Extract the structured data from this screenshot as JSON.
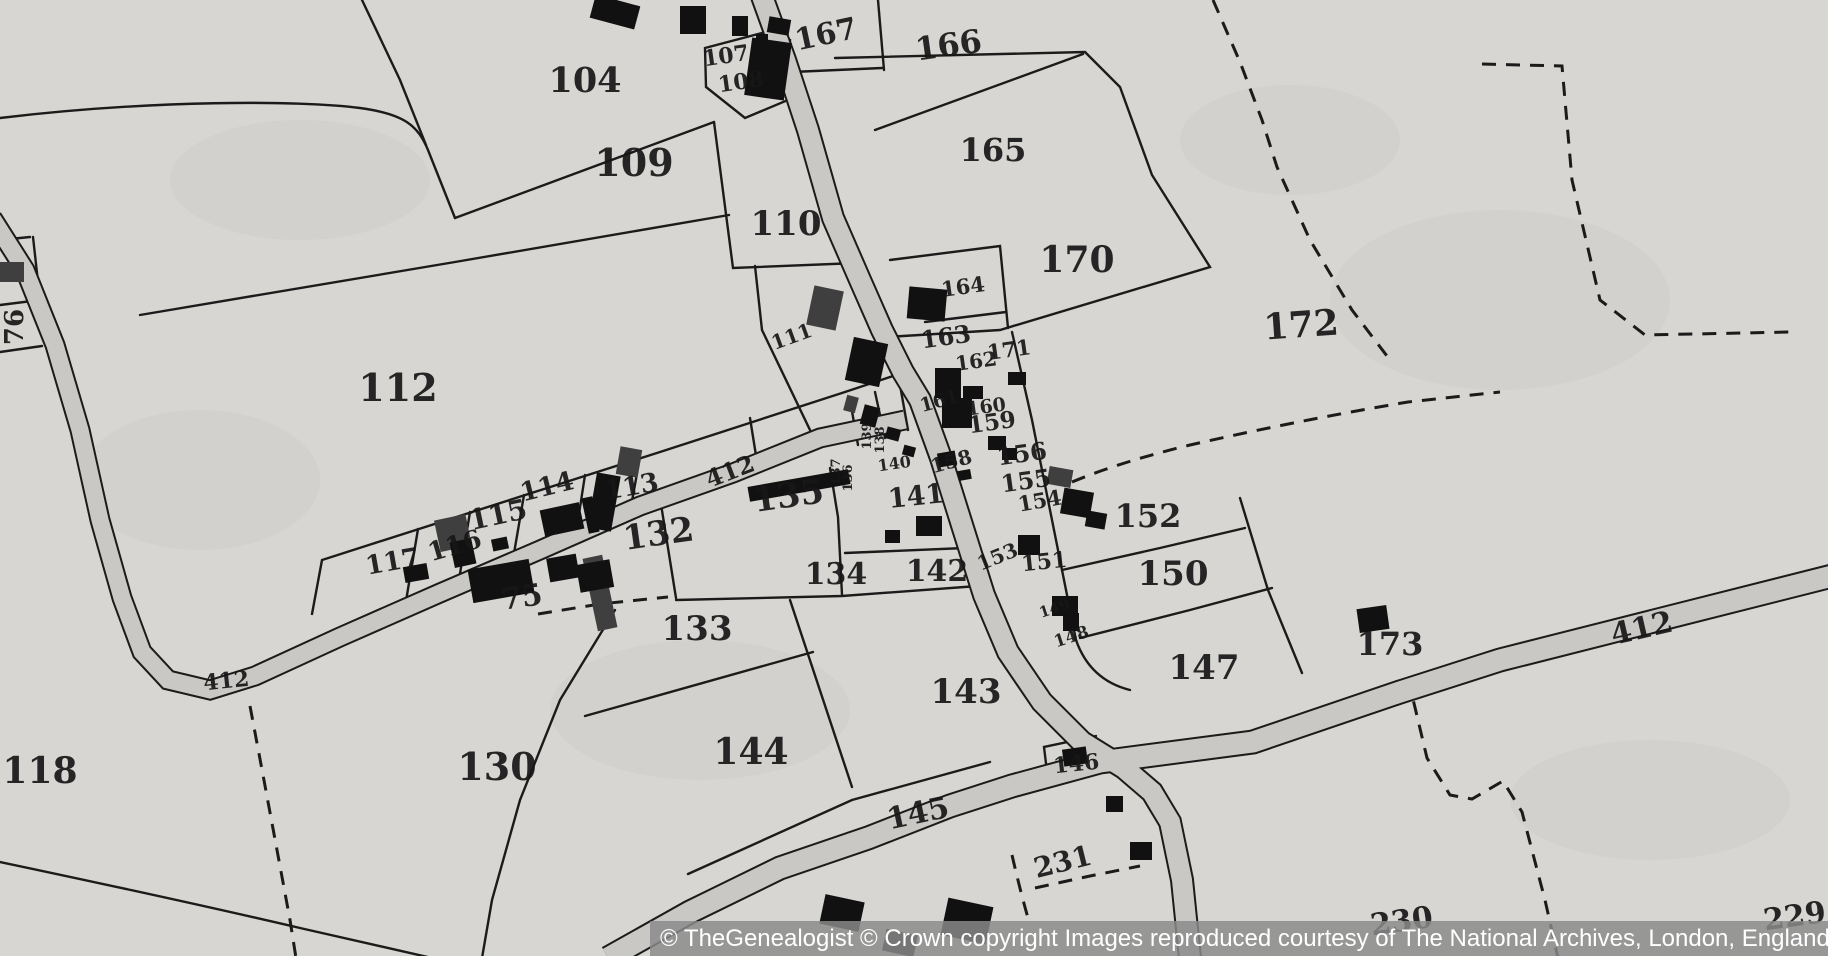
{
  "map": {
    "colors": {
      "paper": "#d7d6d2",
      "road_fill": "#c9c8c4",
      "line": "#1b1b1b",
      "building": "#111111",
      "building_shaded": "#3f3f3f"
    },
    "labels": [
      {
        "text": "104",
        "x": 585,
        "y": 92,
        "size": 35,
        "rot": 0,
        "kind": "parcel"
      },
      {
        "text": "109",
        "x": 634,
        "y": 176,
        "size": 38,
        "rot": 0,
        "kind": "parcel"
      },
      {
        "text": "110",
        "x": 786,
        "y": 235,
        "size": 34,
        "rot": 0,
        "kind": "parcel"
      },
      {
        "text": "112",
        "x": 398,
        "y": 401,
        "size": 38,
        "rot": 0,
        "kind": "parcel"
      },
      {
        "text": "118",
        "x": 40,
        "y": 783,
        "size": 36,
        "rot": 0,
        "kind": "parcel"
      },
      {
        "text": "130",
        "x": 497,
        "y": 780,
        "size": 38,
        "rot": 0,
        "kind": "parcel"
      },
      {
        "text": "132",
        "x": 660,
        "y": 545,
        "size": 34,
        "rot": -8,
        "kind": "parcel"
      },
      {
        "text": "133",
        "x": 697,
        "y": 640,
        "size": 34,
        "rot": 0,
        "kind": "parcel"
      },
      {
        "text": "134",
        "x": 836,
        "y": 584,
        "size": 30,
        "rot": 0,
        "kind": "parcel"
      },
      {
        "text": "135",
        "x": 790,
        "y": 507,
        "size": 34,
        "rot": -8,
        "kind": "parcel"
      },
      {
        "text": "141",
        "x": 917,
        "y": 505,
        "size": 27,
        "rot": -6,
        "kind": "parcel"
      },
      {
        "text": "142",
        "x": 937,
        "y": 581,
        "size": 30,
        "rot": 0,
        "kind": "parcel"
      },
      {
        "text": "143",
        "x": 966,
        "y": 703,
        "size": 34,
        "rot": 0,
        "kind": "parcel"
      },
      {
        "text": "144",
        "x": 751,
        "y": 764,
        "size": 36,
        "rot": 0,
        "kind": "parcel"
      },
      {
        "text": "145",
        "x": 920,
        "y": 823,
        "size": 30,
        "rot": -12,
        "kind": "parcel"
      },
      {
        "text": "147",
        "x": 1204,
        "y": 679,
        "size": 34,
        "rot": 0,
        "kind": "parcel"
      },
      {
        "text": "150",
        "x": 1173,
        "y": 585,
        "size": 34,
        "rot": 0,
        "kind": "parcel"
      },
      {
        "text": "152",
        "x": 1148,
        "y": 527,
        "size": 32,
        "rot": 0,
        "kind": "parcel"
      },
      {
        "text": "165",
        "x": 993,
        "y": 161,
        "size": 32,
        "rot": 0,
        "kind": "parcel"
      },
      {
        "text": "166",
        "x": 950,
        "y": 56,
        "size": 32,
        "rot": -8,
        "kind": "parcel"
      },
      {
        "text": "167",
        "x": 828,
        "y": 44,
        "size": 30,
        "rot": -12,
        "kind": "parcel"
      },
      {
        "text": "170",
        "x": 1077,
        "y": 272,
        "size": 36,
        "rot": 0,
        "kind": "parcel"
      },
      {
        "text": "172",
        "x": 1302,
        "y": 337,
        "size": 36,
        "rot": -4,
        "kind": "parcel"
      },
      {
        "text": "173",
        "x": 1390,
        "y": 655,
        "size": 32,
        "rot": 0,
        "kind": "parcel"
      },
      {
        "text": "231",
        "x": 1065,
        "y": 871,
        "size": 28,
        "rot": -14,
        "kind": "parcel"
      },
      {
        "text": "230",
        "x": 1403,
        "y": 931,
        "size": 30,
        "rot": -8,
        "kind": "parcel"
      },
      {
        "text": "229",
        "x": 1796,
        "y": 926,
        "size": 30,
        "rot": -8,
        "kind": "parcel"
      },
      {
        "text": "75",
        "x": 523,
        "y": 607,
        "size": 30,
        "rot": -8,
        "kind": "parcel"
      },
      {
        "text": "76",
        "x": 23,
        "y": 327,
        "size": 26,
        "rot": -90,
        "kind": "parcel"
      },
      {
        "text": "107",
        "x": 727,
        "y": 63,
        "size": 22,
        "rot": -8,
        "kind": "parcel"
      },
      {
        "text": "108",
        "x": 742,
        "y": 89,
        "size": 22,
        "rot": -8,
        "kind": "parcel"
      },
      {
        "text": "111",
        "x": 794,
        "y": 343,
        "size": 20,
        "rot": -20,
        "kind": "parcel"
      },
      {
        "text": "113",
        "x": 633,
        "y": 495,
        "size": 26,
        "rot": -10,
        "kind": "parcel"
      },
      {
        "text": "114",
        "x": 549,
        "y": 495,
        "size": 26,
        "rot": -14,
        "kind": "parcel"
      },
      {
        "text": "115",
        "x": 500,
        "y": 524,
        "size": 28,
        "rot": -12,
        "kind": "parcel"
      },
      {
        "text": "116",
        "x": 457,
        "y": 554,
        "size": 26,
        "rot": -16,
        "kind": "parcel"
      },
      {
        "text": "117",
        "x": 394,
        "y": 570,
        "size": 26,
        "rot": -10,
        "kind": "parcel"
      },
      {
        "text": "136",
        "x": 852,
        "y": 478,
        "size": 13,
        "rot": -90,
        "kind": "parcel"
      },
      {
        "text": "137",
        "x": 840,
        "y": 472,
        "size": 13,
        "rot": -90,
        "kind": "parcel"
      },
      {
        "text": "138",
        "x": 884,
        "y": 440,
        "size": 13,
        "rot": -90,
        "kind": "parcel"
      },
      {
        "text": "139",
        "x": 871,
        "y": 436,
        "size": 13,
        "rot": -90,
        "kind": "parcel"
      },
      {
        "text": "140",
        "x": 895,
        "y": 469,
        "size": 16,
        "rot": -8,
        "kind": "parcel"
      },
      {
        "text": "146",
        "x": 1077,
        "y": 771,
        "size": 22,
        "rot": -6,
        "kind": "parcel"
      },
      {
        "text": "148",
        "x": 1073,
        "y": 642,
        "size": 17,
        "rot": -18,
        "kind": "parcel"
      },
      {
        "text": "149",
        "x": 1056,
        "y": 613,
        "size": 15,
        "rot": -18,
        "kind": "parcel"
      },
      {
        "text": "151",
        "x": 1045,
        "y": 569,
        "size": 22,
        "rot": -6,
        "kind": "parcel"
      },
      {
        "text": "153",
        "x": 1000,
        "y": 563,
        "size": 20,
        "rot": -22,
        "kind": "parcel"
      },
      {
        "text": "154",
        "x": 1041,
        "y": 508,
        "size": 21,
        "rot": -10,
        "kind": "parcel"
      },
      {
        "text": "155",
        "x": 1027,
        "y": 489,
        "size": 24,
        "rot": -8,
        "kind": "parcel"
      },
      {
        "text": "156",
        "x": 1023,
        "y": 462,
        "size": 24,
        "rot": -8,
        "kind": "parcel"
      },
      {
        "text": "158",
        "x": 953,
        "y": 468,
        "size": 20,
        "rot": -15,
        "kind": "parcel"
      },
      {
        "text": "159",
        "x": 993,
        "y": 430,
        "size": 23,
        "rot": -8,
        "kind": "parcel"
      },
      {
        "text": "160",
        "x": 987,
        "y": 413,
        "size": 19,
        "rot": -8,
        "kind": "parcel"
      },
      {
        "text": "161",
        "x": 941,
        "y": 407,
        "size": 19,
        "rot": -15,
        "kind": "parcel"
      },
      {
        "text": "162",
        "x": 977,
        "y": 368,
        "size": 20,
        "rot": -8,
        "kind": "parcel"
      },
      {
        "text": "163",
        "x": 947,
        "y": 345,
        "size": 24,
        "rot": -8,
        "kind": "parcel"
      },
      {
        "text": "164",
        "x": 964,
        "y": 294,
        "size": 21,
        "rot": -8,
        "kind": "parcel"
      },
      {
        "text": "171",
        "x": 1010,
        "y": 357,
        "size": 21,
        "rot": -8,
        "kind": "parcel"
      },
      {
        "text": "412",
        "x": 227,
        "y": 688,
        "size": 22,
        "rot": -6,
        "kind": "road"
      },
      {
        "text": "412",
        "x": 733,
        "y": 479,
        "size": 24,
        "rot": -21,
        "kind": "road"
      },
      {
        "text": "412",
        "x": 1644,
        "y": 638,
        "size": 30,
        "rot": -13,
        "kind": "road"
      }
    ]
  },
  "footer": {
    "text": "© TheGenealogist © Crown copyright Images reproduced courtesy of The National Archives, London, England",
    "background": "#8a8a8a",
    "text_color": "#ffffff"
  }
}
